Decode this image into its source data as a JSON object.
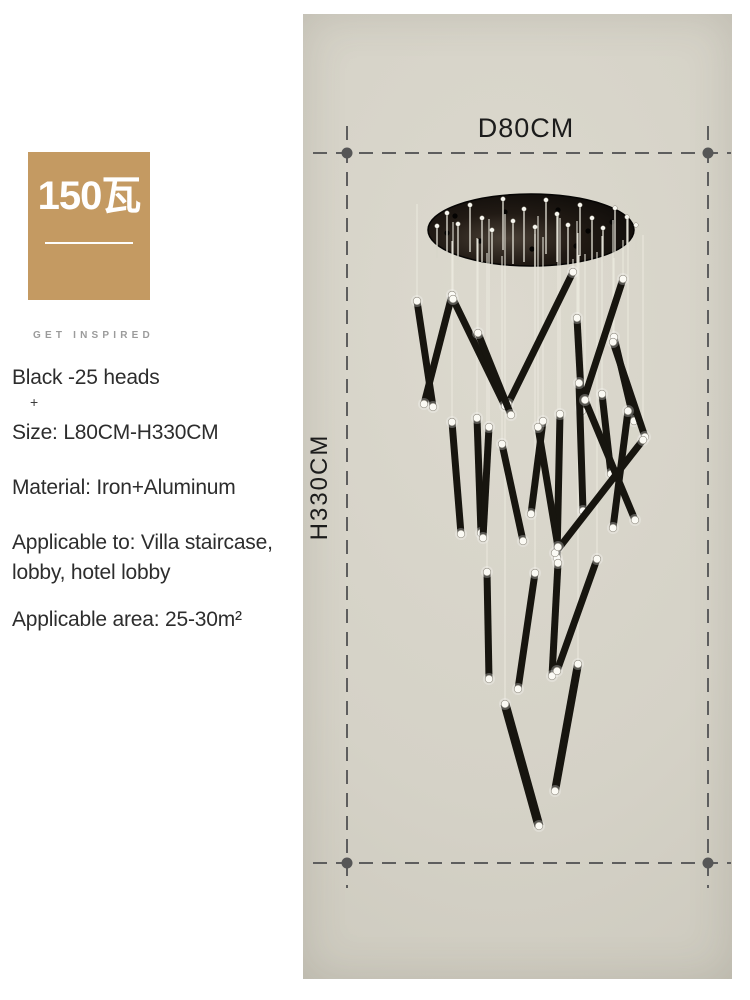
{
  "badge": {
    "wattage": "150瓦",
    "tagline": "GET INSPIRED",
    "bg_color": "#c49a62",
    "text_color": "#ffffff",
    "tagline_color": "#9b9b9b"
  },
  "specs": {
    "heads": "Black -25 heads",
    "plus": "+",
    "size": "Size: L80CM-H330CM",
    "material": "Material: Iron+Aluminum",
    "applicable_line1": "Applicable to: Villa staircase,",
    "applicable_line2": "lobby, hotel lobby",
    "area": "Applicable area: 25-30m²",
    "text_color": "#2d2d2d"
  },
  "diagram": {
    "width_label": "D80CM",
    "height_label": "H330CM",
    "colors": {
      "photo_bg": "#d5d2c7",
      "dash_line": "#5e5e5e",
      "dot": "#565656",
      "canopy": "#17120e",
      "rod": "#17150f",
      "wire": "#eae8dd",
      "tip": "#fbfaf4",
      "label_text": "#1c1c1c"
    },
    "dim": {
      "left_x": 347,
      "right_x": 708,
      "top_y": 153,
      "bottom_y": 863,
      "h_ext": [
        313,
        731
      ],
      "v_ext": [
        126,
        888
      ]
    },
    "canopy": {
      "cx": 531,
      "cy": 230,
      "rx": 103,
      "ry": 36
    },
    "rods": [
      [
        417,
        301,
        433,
        407
      ],
      [
        452,
        295,
        424,
        404
      ],
      [
        453,
        299,
        505,
        406
      ],
      [
        573,
        272,
        508,
        404
      ],
      [
        623,
        279,
        581,
        408
      ],
      [
        577,
        318,
        582,
        411
      ],
      [
        614,
        337,
        634,
        421
      ],
      [
        478,
        333,
        511,
        415
      ],
      [
        613,
        342,
        645,
        437
      ],
      [
        452,
        422,
        461,
        534
      ],
      [
        477,
        418,
        481,
        533
      ],
      [
        489,
        427,
        483,
        538
      ],
      [
        502,
        444,
        523,
        541
      ],
      [
        543,
        421,
        531,
        514
      ],
      [
        560,
        414,
        557,
        558
      ],
      [
        579,
        383,
        583,
        511
      ],
      [
        602,
        394,
        611,
        474
      ],
      [
        628,
        411,
        613,
        528
      ],
      [
        585,
        400,
        635,
        520
      ],
      [
        643,
        440,
        555,
        553
      ],
      [
        538,
        427,
        558,
        547
      ],
      [
        487,
        572,
        489,
        679
      ],
      [
        535,
        573,
        518,
        689
      ],
      [
        558,
        563,
        552,
        676
      ],
      [
        597,
        559,
        557,
        671
      ],
      [
        578,
        664,
        555,
        791,
        8
      ],
      [
        505,
        704,
        539,
        826,
        9
      ]
    ],
    "pins": [
      [
        437,
        226,
        258
      ],
      [
        447,
        213,
        252
      ],
      [
        458,
        224,
        260
      ],
      [
        470,
        205,
        252
      ],
      [
        482,
        218,
        262
      ],
      [
        492,
        230,
        266
      ],
      [
        503,
        199,
        250
      ],
      [
        513,
        221,
        264
      ],
      [
        524,
        209,
        262
      ],
      [
        535,
        227,
        267
      ],
      [
        546,
        200,
        254
      ],
      [
        557,
        214,
        262
      ],
      [
        568,
        225,
        265
      ],
      [
        580,
        205,
        256
      ],
      [
        592,
        218,
        260
      ],
      [
        603,
        228,
        262
      ],
      [
        615,
        208,
        252
      ],
      [
        627,
        217,
        255
      ],
      [
        636,
        225,
        250
      ]
    ],
    "holes": [
      [
        455,
        216
      ],
      [
        505,
        212
      ],
      [
        558,
        210
      ],
      [
        588,
        231
      ],
      [
        612,
        222
      ],
      [
        480,
        241
      ],
      [
        532,
        249
      ],
      [
        576,
        246
      ],
      [
        447,
        233
      ]
    ]
  }
}
